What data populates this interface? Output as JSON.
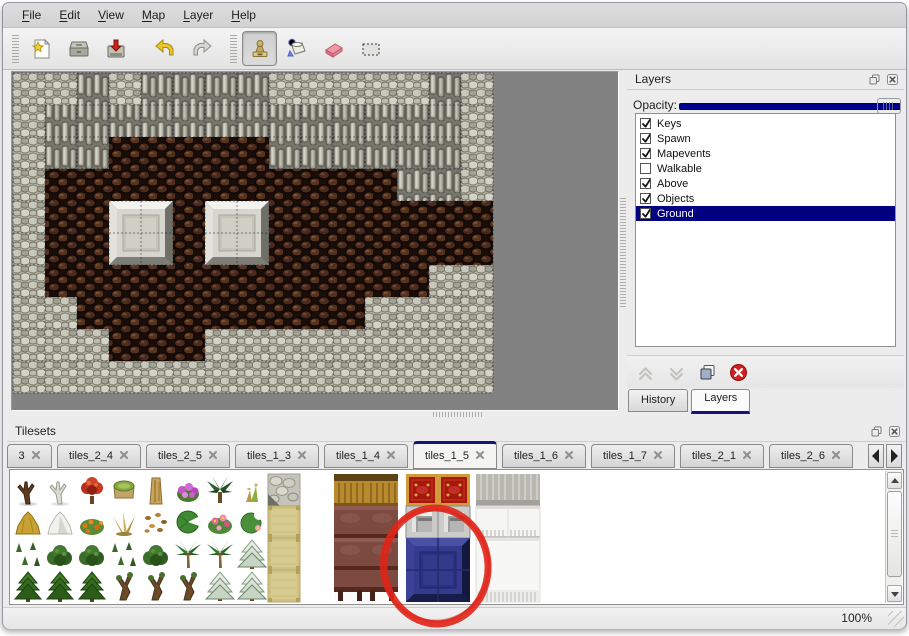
{
  "menu": {
    "items": [
      "File",
      "Edit",
      "View",
      "Map",
      "Layer",
      "Help"
    ]
  },
  "toolbar": {
    "file_buttons": [
      "new-file",
      "open",
      "save"
    ],
    "edit_buttons": [
      "undo",
      "redo"
    ],
    "tools": [
      {
        "icon": "stamp",
        "active": true
      },
      {
        "icon": "fill",
        "active": false
      },
      {
        "icon": "eraser",
        "active": false
      },
      {
        "icon": "select",
        "active": false
      }
    ]
  },
  "layers_panel": {
    "title": "Layers",
    "window_buttons": [
      "float",
      "close"
    ],
    "opacity_label": "Opacity:",
    "opacity_percent": 100,
    "layers": [
      {
        "name": "Keys",
        "checked": true,
        "selected": false
      },
      {
        "name": "Spawn",
        "checked": true,
        "selected": false
      },
      {
        "name": "Mapevents",
        "checked": true,
        "selected": false
      },
      {
        "name": "Walkable",
        "checked": false,
        "selected": false
      },
      {
        "name": "Above",
        "checked": true,
        "selected": false
      },
      {
        "name": "Objects",
        "checked": true,
        "selected": false
      },
      {
        "name": "Ground",
        "checked": true,
        "selected": true
      }
    ],
    "layer_buttons": [
      "move-up",
      "move-down",
      "duplicate",
      "delete"
    ],
    "bottom_tabs": [
      {
        "label": "History",
        "active": false
      },
      {
        "label": "Layers",
        "active": true
      }
    ]
  },
  "tilesets_panel": {
    "title": "Tilesets",
    "window_buttons": [
      "float",
      "close"
    ],
    "tabs": [
      {
        "label": "3",
        "active": false
      },
      {
        "label": "tiles_2_4",
        "active": false
      },
      {
        "label": "tiles_2_5",
        "active": false
      },
      {
        "label": "tiles_1_3",
        "active": false
      },
      {
        "label": "tiles_1_4",
        "active": false
      },
      {
        "label": "tiles_1_5",
        "active": true
      },
      {
        "label": "tiles_1_6",
        "active": false
      },
      {
        "label": "tiles_1_7",
        "active": false
      },
      {
        "label": "tiles_2_1",
        "active": false
      },
      {
        "label": "tiles_2_6",
        "active": false
      }
    ],
    "scroll_buttons": [
      "left",
      "right"
    ]
  },
  "map": {
    "tile_size": 32,
    "columns": 15,
    "rows_count": 10,
    "legend": {
      "L": "light-rock",
      "W": "wall-rock",
      "F": "brown-floor"
    },
    "rows": [
      "LLWLWWWWLLLLLWL",
      "LWWWWWWWWWWWWWL",
      "LWWFFFFFWWWWWWL",
      "LFFFFFFFFFFFWWL",
      "LFFFFFFFFFFFFFF",
      "LFFFFFFFFFFFFFF",
      "LFFFFFFFFFFFFLL",
      "LLFFFFFFFFFLLLL",
      "LLLFFFLLLLLLLLL",
      "LLLLLLLLLLLLLLL"
    ],
    "blocks": [
      {
        "col": 3,
        "row": 4
      },
      {
        "col": 6,
        "row": 4
      }
    ]
  },
  "tileset_content": {
    "vegetation_rows": [
      [
        "dead-tree",
        "white-tree",
        "red-flower-tree",
        "stump",
        "trunk",
        "purple-flower-bush",
        "dark-palm",
        "sprig"
      ],
      [
        "hay-mound",
        "snow-mound",
        "orange-flowers",
        "dry-grass",
        "fallen-leaves",
        "lily-pad",
        "pink-flowers",
        "lily-pad-flower"
      ],
      [
        "grass-tufts",
        "grass-bush",
        "grass-bush",
        "grass-tufts",
        "grass-bush",
        "palm-tree",
        "palm-tree",
        "snow-tree"
      ],
      [
        "conifer",
        "conifer",
        "conifer",
        "gnarled-tree",
        "gnarled-tree",
        "gnarled-tree",
        "snow-tree",
        "snow-tree"
      ]
    ],
    "furniture_tiles": [
      {
        "type": "stone-tile",
        "x": 258,
        "y": 4
      },
      {
        "type": "tan-tile",
        "x": 258,
        "y": 36
      },
      {
        "type": "tan-tile",
        "x": 258,
        "y": 68
      },
      {
        "type": "tan-tile",
        "x": 258,
        "y": 100
      },
      {
        "type": "gold-wood-tile",
        "x": 324,
        "y": 4
      },
      {
        "type": "gold-wood-tile",
        "x": 356,
        "y": 4
      },
      {
        "type": "maroon-tile",
        "x": 324,
        "y": 36
      },
      {
        "type": "maroon-tile",
        "x": 356,
        "y": 36
      },
      {
        "type": "maroon-tile",
        "x": 324,
        "y": 68
      },
      {
        "type": "maroon-tile",
        "x": 356,
        "y": 68
      },
      {
        "type": "maroon-table",
        "x": 324,
        "y": 100
      },
      {
        "type": "maroon-table",
        "x": 356,
        "y": 100
      },
      {
        "type": "red-carpet-tile",
        "x": 396,
        "y": 4
      },
      {
        "type": "red-carpet-tile",
        "x": 428,
        "y": 4
      },
      {
        "type": "silver-tile",
        "x": 396,
        "y": 36
      },
      {
        "type": "silver-tile",
        "x": 428,
        "y": 36
      },
      {
        "type": "gray-cloth-tile",
        "x": 466,
        "y": 4
      },
      {
        "type": "gray-cloth-tile",
        "x": 498,
        "y": 4
      },
      {
        "type": "white-fringe-tile",
        "x": 466,
        "y": 36
      },
      {
        "type": "white-fringe-tile",
        "x": 498,
        "y": 36
      },
      {
        "type": "white-block",
        "x": 466,
        "y": 68
      }
    ],
    "selected_tile": {
      "type": "blue-block",
      "x": 396,
      "y": 68,
      "w": 64,
      "h": 64
    },
    "annotation": {
      "shape": "ellipse",
      "color": "#e02418"
    }
  },
  "statusbar": {
    "zoom": "100%"
  },
  "colors": {
    "selection": "#000080",
    "slider": "#00008b",
    "tab_accent": "#14147c",
    "annotation_red": "#e02418"
  }
}
